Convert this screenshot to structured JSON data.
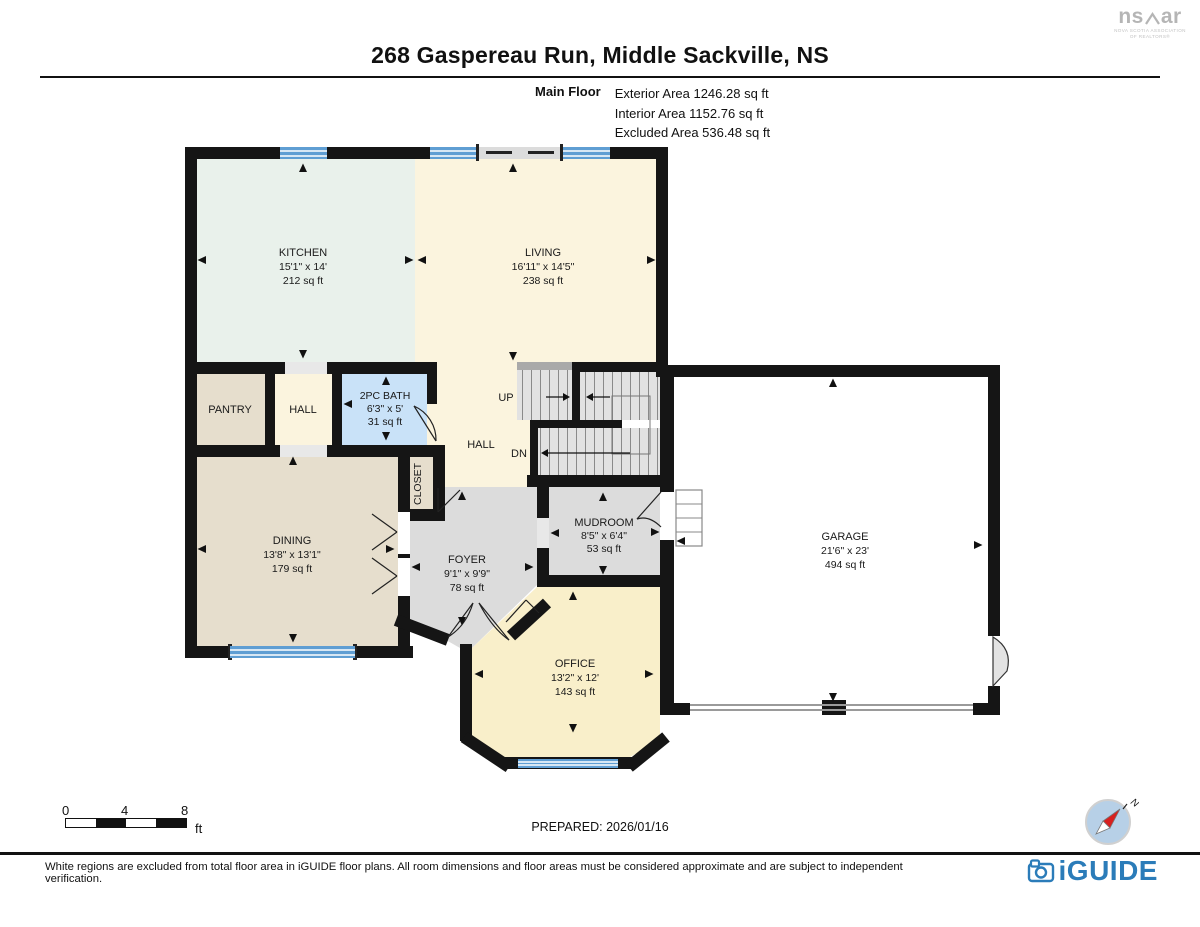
{
  "header": {
    "title": "268 Gaspereau Run, Middle Sackville, NS",
    "nsar": {
      "left": "ns",
      "right": "ar",
      "sub1": "NOVA SCOTIA ASSOCIATION",
      "sub2": "OF REALTORS®"
    }
  },
  "floor_info": {
    "floor_label": "Main Floor",
    "exterior": "Exterior Area 1246.28 sq ft",
    "interior": "Interior Area 1152.76 sq ft",
    "excluded": "Excluded Area 536.48 sq ft"
  },
  "rooms": {
    "kitchen": {
      "name": "KITCHEN",
      "dims": "15'1\" x 14'",
      "area": "212 sq ft"
    },
    "living": {
      "name": "LIVING",
      "dims": "16'11\" x 14'5\"",
      "area": "238 sq ft"
    },
    "bath": {
      "name": "2PC BATH",
      "dims": "6'3\" x 5'",
      "area": "31 sq ft"
    },
    "pantry": {
      "name": "PANTRY"
    },
    "hall_upper": {
      "name": "HALL"
    },
    "hall_lower": {
      "name": "HALL"
    },
    "closet": {
      "name": "CLOSET"
    },
    "dining": {
      "name": "DINING",
      "dims": "13'8\" x 13'1\"",
      "area": "179 sq ft"
    },
    "foyer": {
      "name": "FOYER",
      "dims": "9'1\" x 9'9\"",
      "area": "78 sq ft"
    },
    "mudroom": {
      "name": "MUDROOM",
      "dims": "8'5\" x 6'4\"",
      "area": "53 sq ft"
    },
    "office": {
      "name": "OFFICE",
      "dims": "13'2\" x 12'",
      "area": "143 sq ft"
    },
    "garage": {
      "name": "GARAGE",
      "dims": "21'6\" x 23'",
      "area": "494 sq ft"
    },
    "stairs": {
      "up": "UP",
      "down": "DN"
    }
  },
  "scale_bar": {
    "t0": "0",
    "t1": "4",
    "t2": "8",
    "unit": "ft"
  },
  "footer": {
    "prepared": "PREPARED: 2026/01/16",
    "disclaimer": "White regions are excluded from total floor area in iGUIDE floor plans. All room dimensions and floor areas must be considered approximate and are subject to independent verification.",
    "brand": "iGUIDE",
    "compass_north": "N"
  },
  "colors": {
    "wall": "#151515",
    "window_blue": "#5f9ed3",
    "kitchen_fill": "#e9f1eb",
    "living_fill": "#fbf4de",
    "tan_fill": "#e6decd",
    "bath_fill": "#c9e2f8",
    "gray_fill": "#dcdcdc",
    "stair_fill": "#e2e2e2",
    "office_fill": "#f9efca",
    "garage_fill": "#ffffff",
    "brand_blue": "#2b7cb9",
    "compass_fill": "#b7d0e7",
    "needle_red": "#d8201f",
    "logo_gray": "#b5b5b5"
  }
}
